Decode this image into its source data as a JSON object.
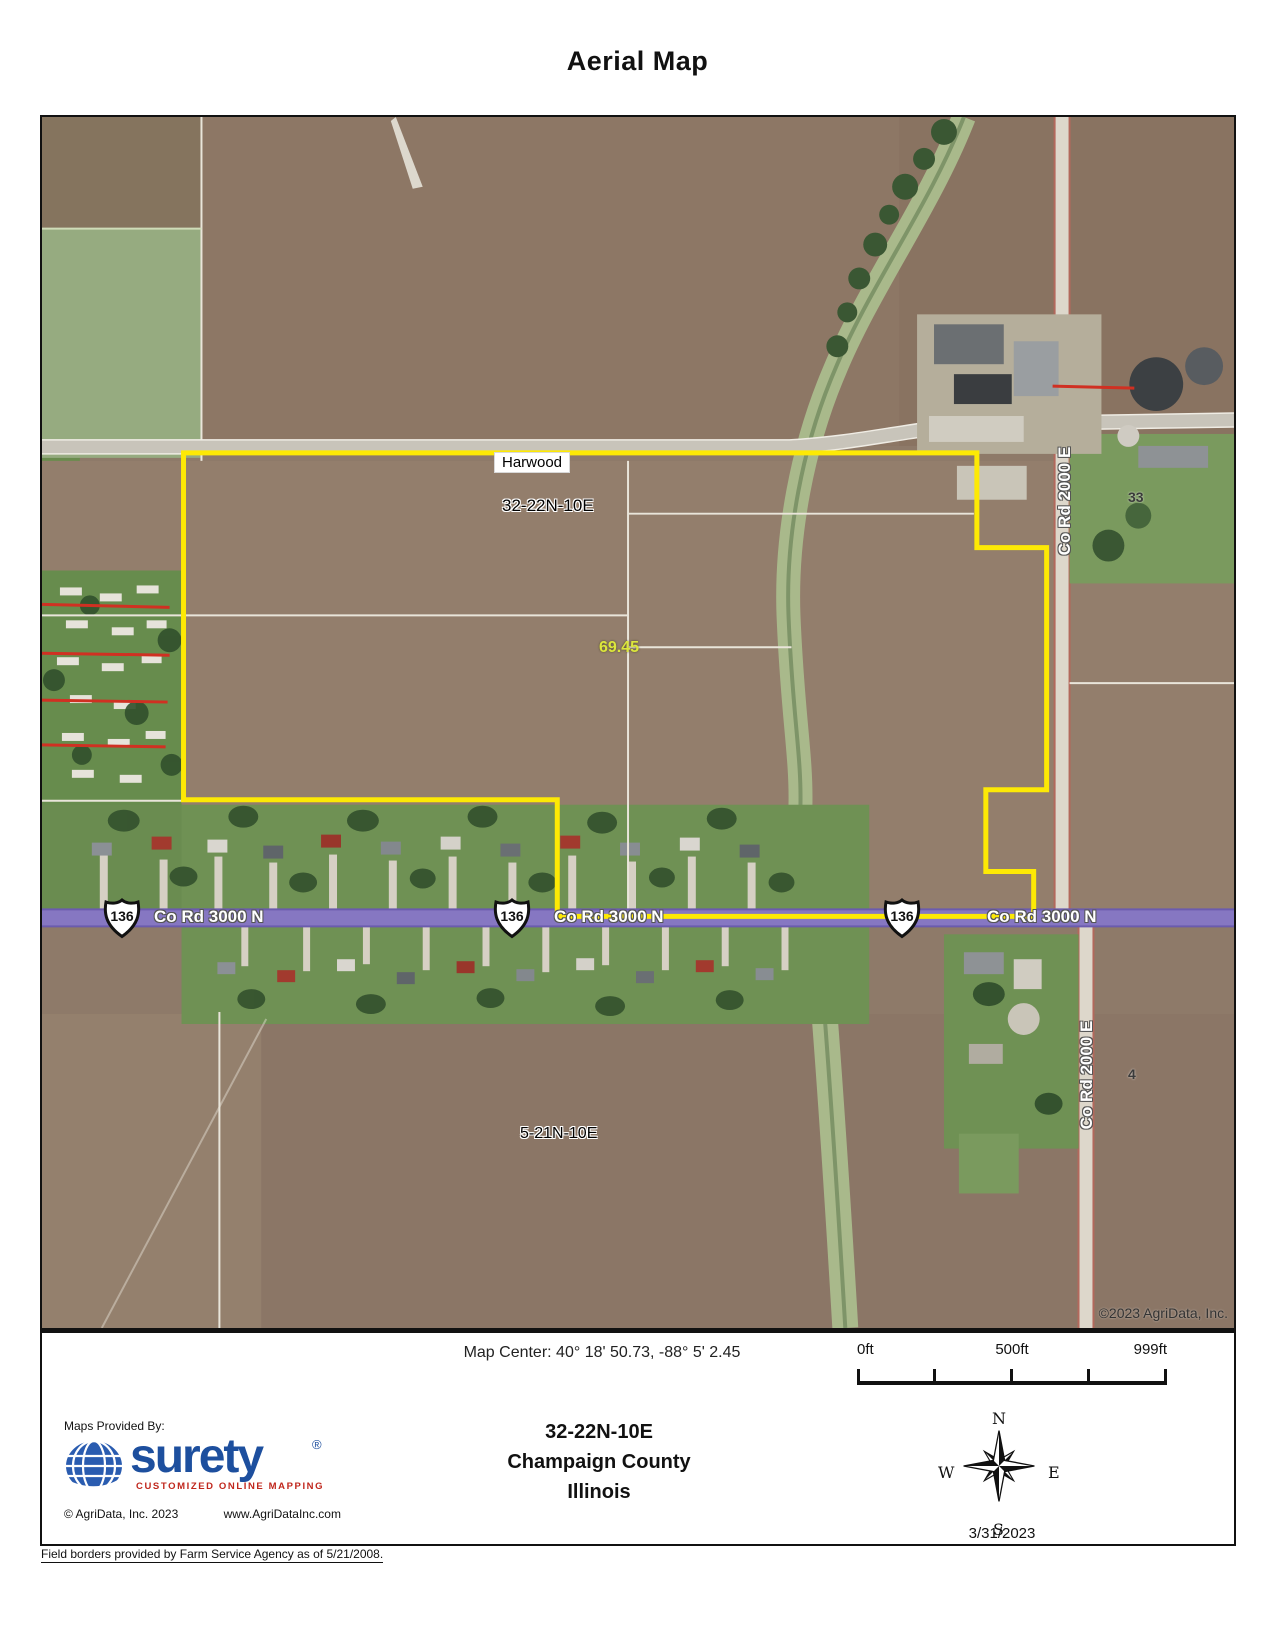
{
  "title": "Aerial Map",
  "map": {
    "labels": {
      "town": "Harwood",
      "section_main": "32-22N-10E",
      "acreage": "69.45",
      "section_south": "5-21N-10E",
      "section_33": "33",
      "section_4": "4",
      "copyright": "©2023 AgriData, Inc."
    },
    "roads": {
      "co_rd_3000n": [
        "Co Rd 3000 N",
        "Co Rd 3000 N",
        "Co Rd 3000 N"
      ],
      "co_rd_2000e": [
        "Co Rd 2000 E",
        "Co Rd 2000 E"
      ],
      "route_shields": [
        "136",
        "136",
        "136"
      ]
    },
    "colors": {
      "parcel_boundary": "#fde905",
      "highway_purple": "#8677c2",
      "acreage_text": "#dce63c",
      "annotation_red": "#d03022"
    }
  },
  "footer": {
    "map_center": "Map Center: 40° 18' 50.73,  -88° 5' 2.45",
    "scale": {
      "start": "0ft",
      "mid": "500ft",
      "end": "999ft"
    },
    "section": "32-22N-10E",
    "county": "Champaign County",
    "state": "Illinois",
    "date": "3/31/2023",
    "compass": {
      "n": "N",
      "e": "E",
      "s": "S",
      "w": "W"
    },
    "provider": {
      "label": "Maps Provided By:",
      "logo_text": "surety",
      "registered": "®",
      "tagline": "CUSTOMIZED ONLINE MAPPING",
      "copyright": "© AgriData, Inc. 2023",
      "url": "www.AgriDataInc.com"
    },
    "field_note": "Field borders provided by Farm Service Agency as of 5/21/2008."
  }
}
